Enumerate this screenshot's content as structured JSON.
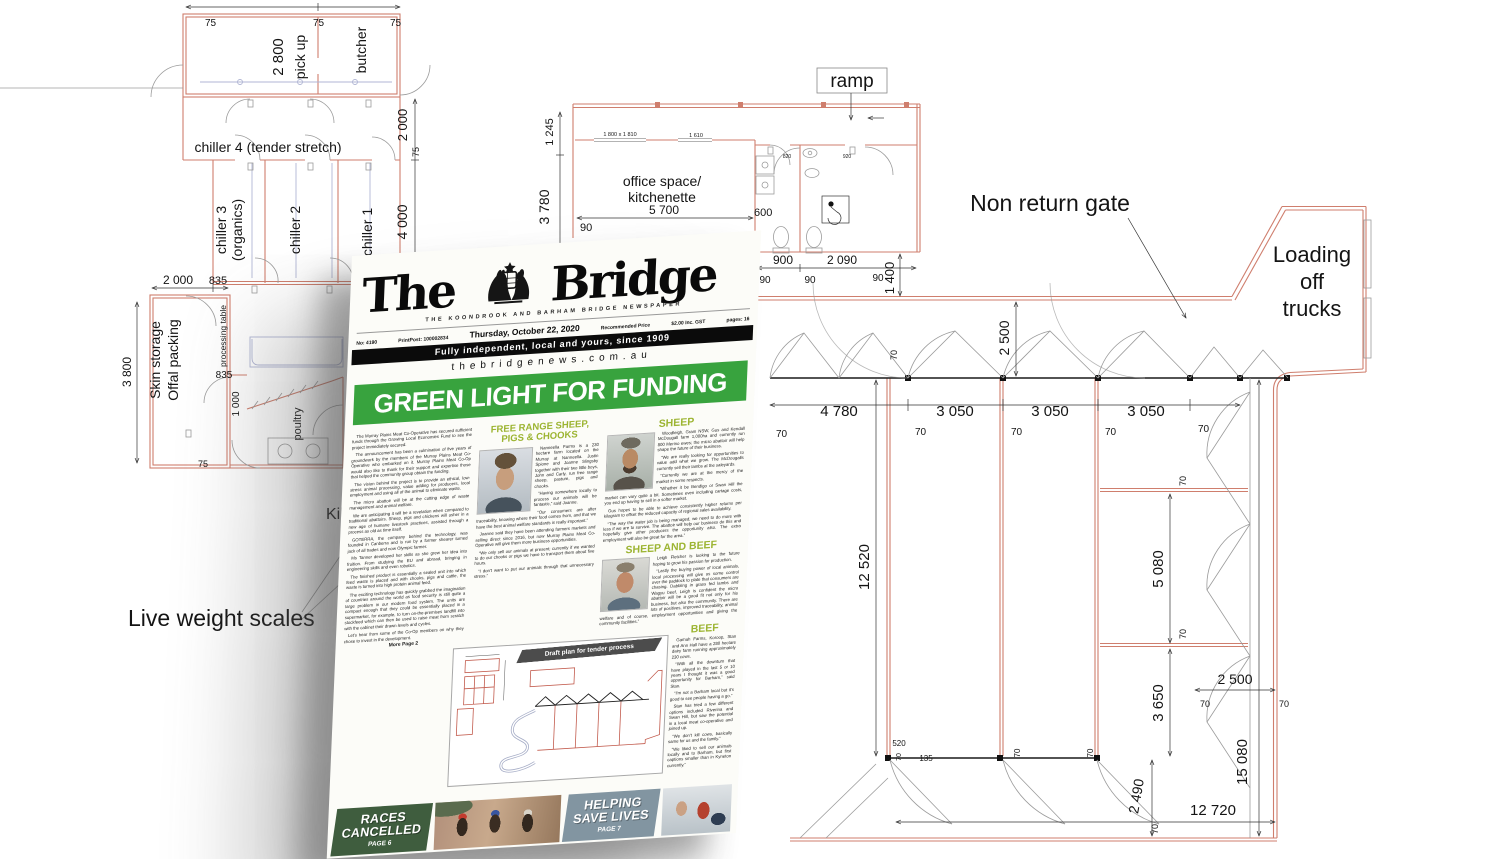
{
  "plan": {
    "rooms": {
      "pickup": "pick up",
      "butcher": "butcher",
      "chiller4": "chiller 4 (tender stretch)",
      "chiller3_line1": "chiller 3",
      "chiller3_line2": "(organics)",
      "chiller2": "chiller 2",
      "chiller1": "chiller 1",
      "skin_line1": "Skin storage",
      "skin_line2": "Offal packing",
      "processing_table": "processing table",
      "poultry": "poultry",
      "office_line1": "office space/",
      "office_line2": "kitchenette",
      "ramp": "ramp"
    },
    "labels": {
      "non_return_gate": "Non return gate",
      "loading_line1": "Loading",
      "loading_line2": "off",
      "loading_line3": "trucks",
      "live_weight_scales": "Live weight scales",
      "kill_floor": "Kill floor"
    },
    "dims": {
      "d75": "75",
      "d2800": "2 800",
      "d2000": "2 000",
      "d4000": "4 000",
      "d835": "835",
      "d3800": "3 800",
      "d1000": "1 000",
      "d1245": "1 245",
      "d3780": "3 780",
      "d5700": "5 700",
      "d90": "90",
      "d600": "600",
      "d820": "820",
      "d920": "920",
      "d900": "900",
      "d2090": "2 090",
      "d1400": "1 400",
      "d2500": "2 500",
      "d4780": "4 780",
      "d3050": "3 050",
      "d70": "70",
      "d12520": "12 520",
      "d5080": "5 080",
      "d3650": "3 650",
      "d15080": "15 080",
      "d2490": "2 490",
      "d12720": "12 720",
      "d520": "520",
      "d135": "135",
      "w1800": "1 800 x 1 810",
      "w1610": "1 610"
    }
  },
  "newspaper": {
    "masthead": {
      "title_the": "The",
      "title_bridge": "Bridge",
      "subtitle": "THE KOONDROOK AND BARHAM BRIDGE NEWSPAPER",
      "issue": "No: 4190",
      "print_post": "PrintPost: 100002834",
      "date": "Thursday, October 22, 2020",
      "price_label": "Recommended Price",
      "price": "$2.00 Inc. GST",
      "pages": "pages: 16",
      "tagline": "Fully independent, local and yours, since 1909",
      "website": "thebridgenews.com.au"
    },
    "headline": "GREEN LIGHT FOR FUNDING",
    "col1": {
      "paragraphs": [
        "The Murray Plains Meat Co-Operative has secured sufficient funds through the Growing Local Economies Fund to see the project immediately secured.",
        "The announcement has been a culmination of five years of groundwork by the members of the Murray Plains Meat Co-Operative who embarked on it. Murray Plains Meat Co-Op would also like to thank for their support and expertise those that helped the community group obtain the funding.",
        "The vision behind the project is to provide an ethical, low-stress animal processing, value adding for producers, local employment and using all of the animal to eliminate waste.",
        "The micro abattoir will be at the cutting edge of waste management and animal welfare.",
        "We are anticipating it will be a revelation when compared to traditional abattoirs. Sheep, pigs and chickens will usher in a new age of humane livestock practices, assisted through a process as old as time itself.",
        "GOTERRA, the company behind the technology, was founded in Canberra and is run by a former shearer turned jack of all trades and now Olympic farmer.",
        "Ms Tanner developed her skills as she grew her idea into fruition. From studying the EU and abroad, bringing in engineering skills and even robotics.",
        "The finished product is essentially a sealed unit into which feed waste is placed and with chooks, pigs and cattle, the waste is turned into high protein animal feed.",
        "The exciting technology has quickly grabbed the imagination of countries around the world as food security is still quite a large problem in our modern food system. The units are compact enough that they could be essentially placed in a supermarket, for example, to turn on-the-premises landfill into stockfeed which can then be used to raise meat from scratch with the cabinet their drawn levels and cycles.",
        "Let's hear from some of the Co-Op members on why they chose to invest in the development."
      ],
      "more": "More Page 2"
    },
    "col2": {
      "heading": "FREE RANGE SHEEP, PIGS & CHOOKS",
      "paragraphs": [
        "Nanneella Farms is a 230 hectare farm located on the Murray at Nanneella. Justin Spione and Joanne Slingsby together with their two little boys, John and Carly, run free range sheep, pasture, pigs and chooks.",
        "“Having somewhere locally to process our animals will be fantastic,” said Joanne.",
        "“Our consumers are after traceability, knowing where their food comes from, and that we have the best animal welfare standards is really important.”",
        "Joanne said they have been attending farmers markets and selling direct since 2016, but now Murray Plains Meat Co-Operative will give them more business opportunities.",
        "“We only sell our animals at present; currently if we wanted to do our chooks or pigs we have to transport them about five hours.",
        "“I don't want to put our animals through that unnecessary stress.”"
      ]
    },
    "col3": {
      "sheep_heading": "SHEEP",
      "sheep_paragraphs": [
        "Woodleigh, Gram NSW, Gus and Kendall McDougall farm 1,000ha and currently run 800 Merino ewes; the micro abattoir will help shape the future of their business.",
        "“We are really looking for opportunities to value add what we grow. The McDougalls currently sell their lambs at the saleyards.",
        "“Currently we are at the mercy of the market in some respects.",
        "“Whether it be Bendigo or Swan Hill the market can vary quite a bit. Sometimes even including cartage costs, you end up having to sell in a softer market.",
        "Gus hopes to be able to achieve consistently higher returns per kilogram to offset the reduced capacity of regional sales availability.",
        "“The way the water job is being managed, we need to do more with less if we are to survive. The abattoir will help our business do this and hopefully give other producers the opportunity also. The extra employment will also be great for the area.”"
      ],
      "sheep_beef_heading": "SHEEP AND BEEF",
      "sheep_beef_paragraphs": [
        "Leigh Fletcher is looking to the future hoping to grow his passion for production.",
        "“Lastly the buying power of local animals, local processing will give us some control over the paddock to plate that consumers are chasing. Dabbling in grass fed lambs and Wagyu beef, Leigh is confident the micro abattoir will be a good fit not only for his business, but also the community. There are lots of positives, improved traceability, animal welfare and of course, employment opportunities and giving the community facilities.”"
      ],
      "beef_heading": "BEEF",
      "beef_paragraphs": [
        "Gamah Farms, Koroop, Stan and Ann Hall have a 280 hectare dairy farm running approximately 230 cows.",
        "“With all the downturn that have played in the last 5 or 10 years I thought it was a good opportunity for Barham,” said Stan.",
        "“I'm not a Barham local but it's good to see people having a go.”",
        "Stan has tried a few different options included Riverina and Swan Hill, but saw the potential in a local meat co-operative and joined up.",
        "“We don't kill cows, basically same for us and the family.”",
        "“We liked to sell our animals locally and to Barham, but first captions smaller than in Kyneton currently.”"
      ]
    },
    "inset_caption": "Draft plan for tender process",
    "promos": {
      "races": {
        "line1": "RACES",
        "line2": "CANCELLED",
        "page": "PAGE 6"
      },
      "helping": {
        "line1": "HELPING",
        "line2": "SAVE LIVES",
        "page": "PAGE 7"
      }
    }
  },
  "colors": {
    "headline_green": "#38a33e",
    "heading_green": "#9cb431",
    "races_bg": "#3f5d3e",
    "helping_bg": "#8295a1",
    "wall_red": "#cf7e6d"
  }
}
